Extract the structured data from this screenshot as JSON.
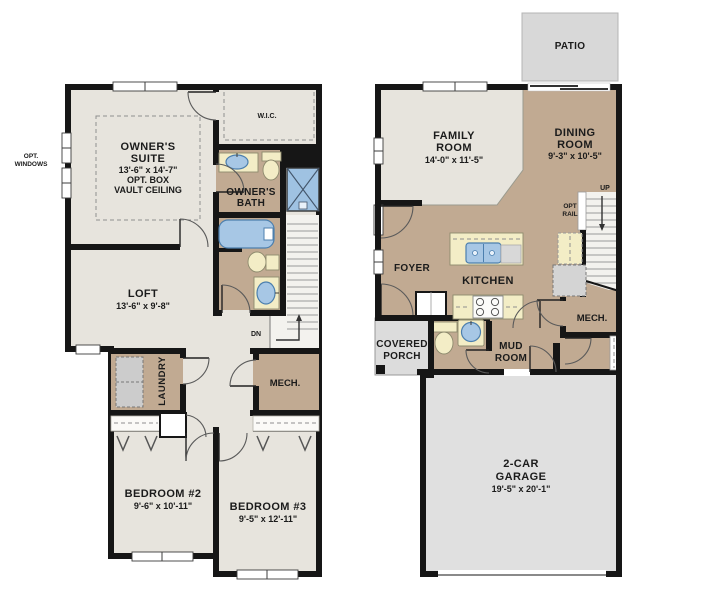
{
  "colors": {
    "wall": "#161616",
    "floor_light": "#e7e4dd",
    "floor_tan": "#c1aa92",
    "concrete_gray": "#dfdfdf",
    "fixture_cream": "#f3edc6",
    "fixture_blue": "#a7c7e5",
    "stair_tread": "#9a9a9a"
  },
  "left_plan": {
    "owners_suite": {
      "name_line1": "OWNER'S",
      "name_line2": "SUITE",
      "dims": "13'-6\" x 14'-7\"",
      "opt_line1": "OPT. BOX",
      "opt_line2": "VAULT CEILING"
    },
    "wic": {
      "name": "W.I.C."
    },
    "owners_bath": {
      "name_line1": "OWNER'S",
      "name_line2": "BATH"
    },
    "opt_windows": {
      "line1": "OPT.",
      "line2": "WINDOWS"
    },
    "loft": {
      "name": "LOFT",
      "dims": "13'-6\" x 9'-8\""
    },
    "stairs": {
      "label": "DN"
    },
    "laundry": {
      "name": "LAUNDRY"
    },
    "mech": {
      "name": "MECH."
    },
    "bedroom2": {
      "name": "BEDROOM #2",
      "dims": "9'-6\" x 10'-11\""
    },
    "bedroom3": {
      "name": "BEDROOM #3",
      "dims": "9'-5\" x 12'-11\""
    }
  },
  "right_plan": {
    "patio": {
      "name": "PATIO"
    },
    "family_room": {
      "name_line1": "FAMILY",
      "name_line2": "ROOM",
      "dims": "14'-0\" x 11'-5\""
    },
    "dining_room": {
      "name_line1": "DINING",
      "name_line2": "ROOM",
      "dims": "9'-3\" x 10'-5\""
    },
    "stairs": {
      "label": "UP"
    },
    "opt_rail": {
      "line1": "OPT",
      "line2": "RAIL"
    },
    "foyer": {
      "name": "FOYER"
    },
    "kitchen": {
      "name": "KITCHEN"
    },
    "covered_porch": {
      "line1": "COVERED",
      "line2": "PORCH"
    },
    "mud_room": {
      "line1": "MUD",
      "line2": "ROOM"
    },
    "mech": {
      "name": "MECH."
    },
    "garage": {
      "name_line1": "2-CAR",
      "name_line2": "GARAGE",
      "dims": "19'-5\" x 20'-1\""
    }
  }
}
